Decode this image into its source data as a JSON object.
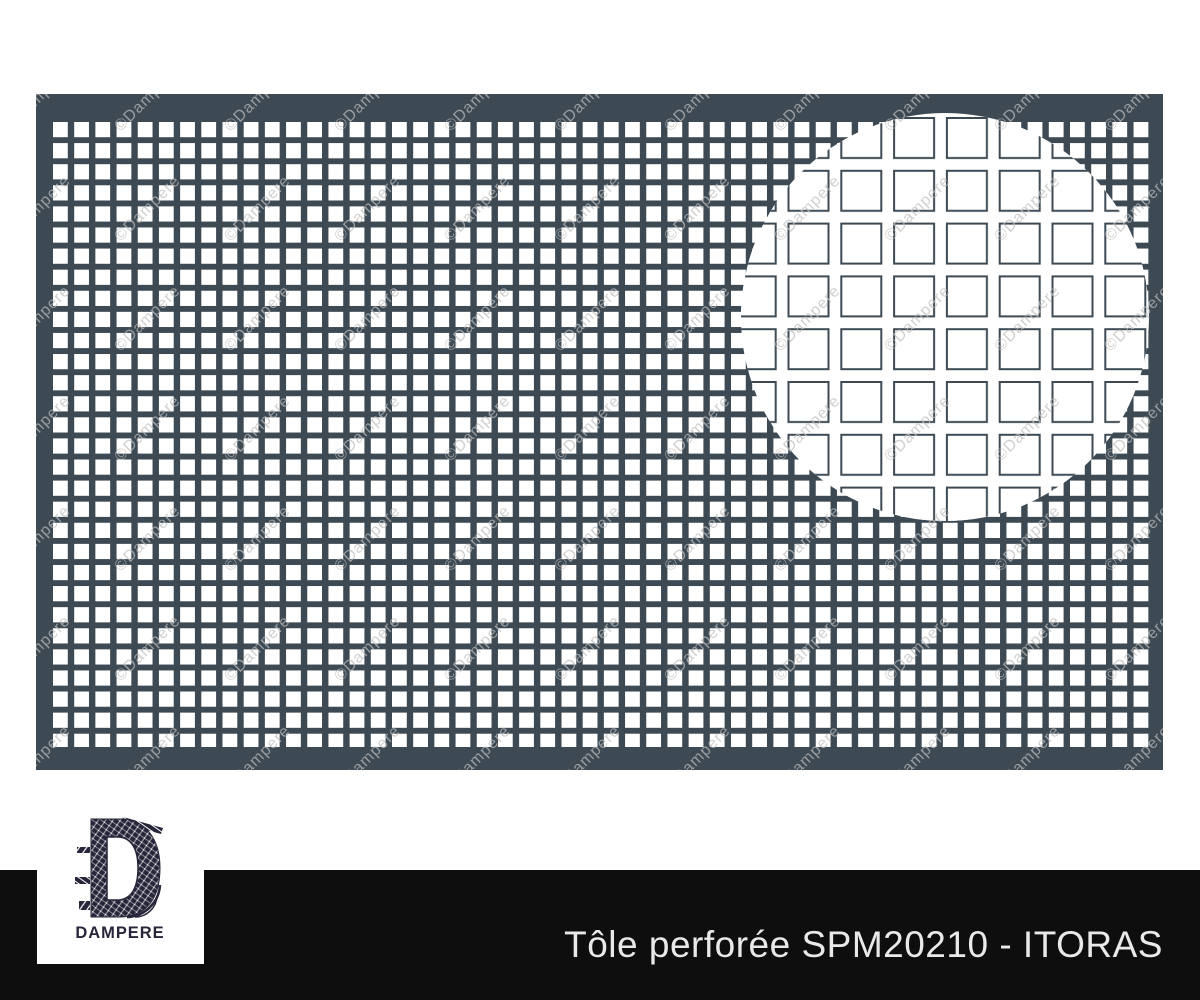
{
  "page": {
    "background": "#ffffff"
  },
  "plate": {
    "color": "#3d4a54",
    "hole_color": "#ffffff",
    "watermark_text": "©Dampere"
  },
  "banner": {
    "product_title": "Tôle perforée SPM20210 - ITORAS",
    "bg_color": "#0e0e0e",
    "text_color": "#e9e9e9"
  },
  "logo": {
    "brand": "DAMPERE",
    "ink_color": "#262539"
  }
}
